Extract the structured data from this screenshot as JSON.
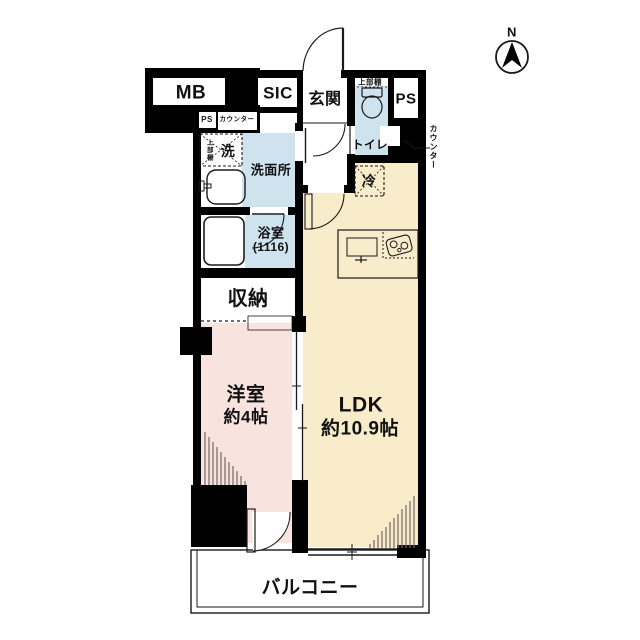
{
  "compass": {
    "label": "N"
  },
  "labels": {
    "mb": "MB",
    "sic": "SIC",
    "genkan": "玄関",
    "shelf_toilet": "上部棚",
    "ps_top": "PS",
    "toilet": "トイレ",
    "counter_right": "カウンター",
    "ps_small": "PS",
    "counter_small": "カウンター",
    "shelf_washer": "上部棚",
    "washer": "洗",
    "washroom": "洗面所",
    "fridge": "冷",
    "bath": "浴室",
    "bath_size": "(1116)",
    "closet": "収納",
    "western": "洋室",
    "western_size": "約4帖",
    "ldk": "LDK",
    "ldk_size": "約10.9帖",
    "balcony": "バルコニー"
  },
  "colors": {
    "wall": "#000000",
    "blue": "#cfe3ee",
    "cream": "#f9ecca",
    "pink": "#f9e3de",
    "hatch": "#75685f",
    "line": "#1a1a1a"
  }
}
